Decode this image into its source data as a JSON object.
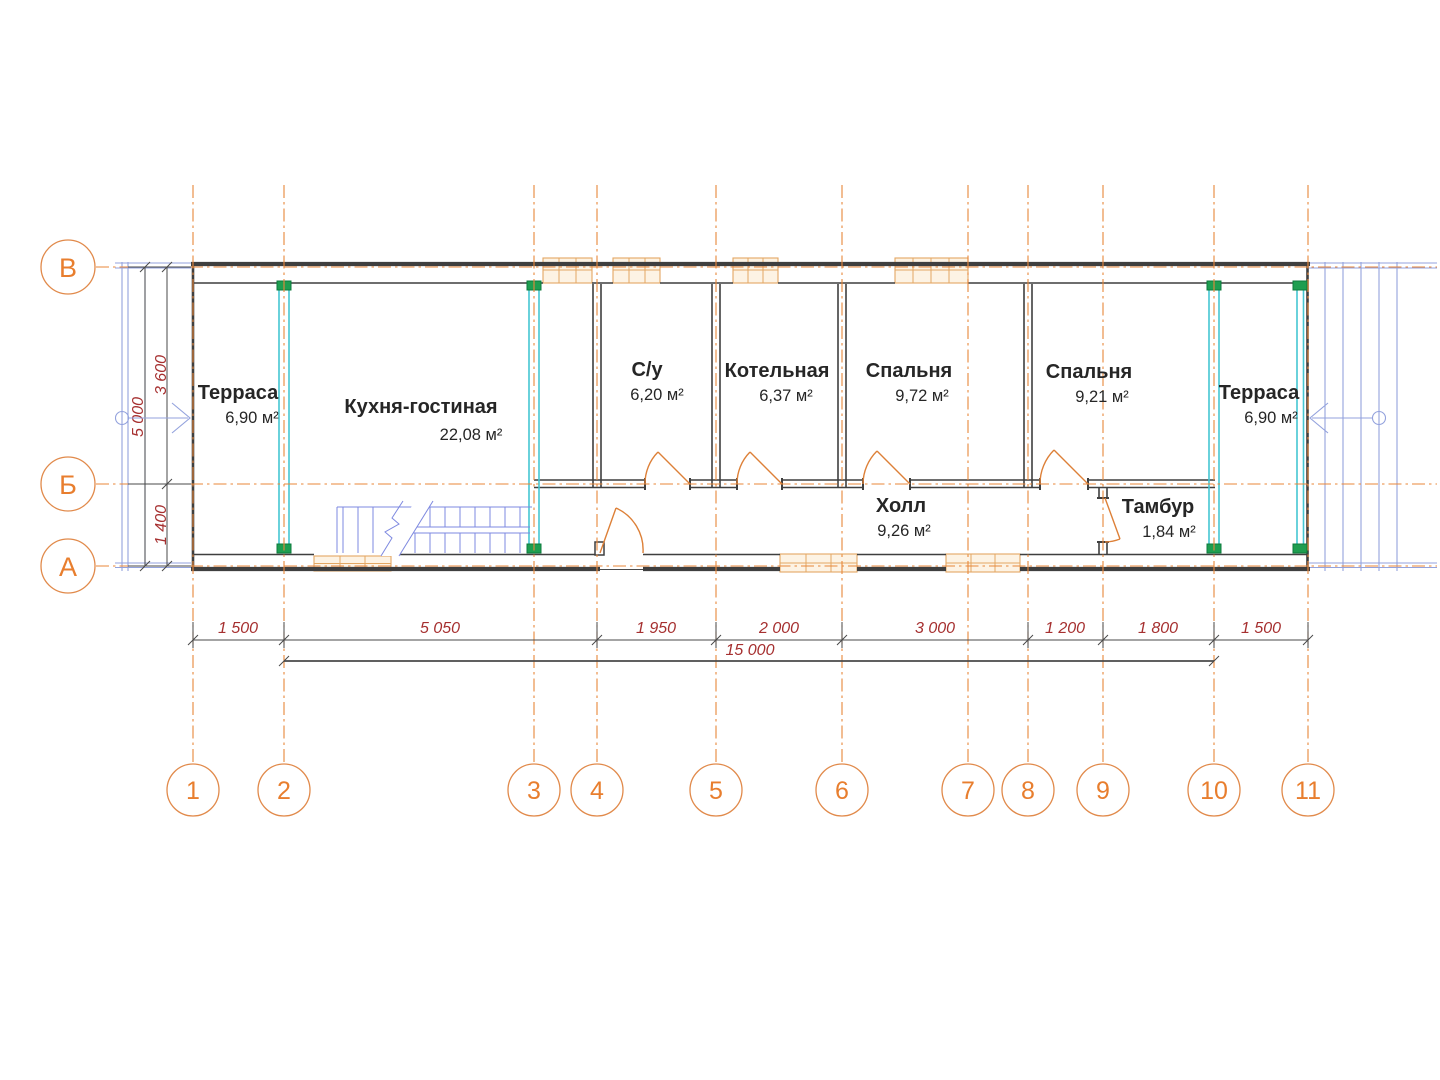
{
  "axes": {
    "rows": [
      "В",
      "Б",
      "А"
    ],
    "cols": [
      "1",
      "2",
      "3",
      "4",
      "5",
      "6",
      "7",
      "8",
      "9",
      "10",
      "11"
    ]
  },
  "rooms": [
    {
      "name": "Терраса",
      "area": "6,90 м²"
    },
    {
      "name": "Кухня-гостиная",
      "area": "22,08 м²"
    },
    {
      "name": "С/у",
      "area": "6,20 м²"
    },
    {
      "name": "Котельная",
      "area": "6,37 м²"
    },
    {
      "name": "Спальня",
      "area": "9,72 м²"
    },
    {
      "name": "Спальня",
      "area": "9,21 м²"
    },
    {
      "name": "Терраса",
      "area": "6,90 м²"
    },
    {
      "name": "Холл",
      "area": "9,26 м²"
    },
    {
      "name": "Тамбур",
      "area": "1,84 м²"
    }
  ],
  "dims": {
    "bottom": [
      "1 500",
      "5 050",
      "1 950",
      "2 000",
      "3 000",
      "1 200",
      "1 800",
      "1 500"
    ],
    "total": "15 000",
    "left": [
      "5 000",
      "3 600",
      "1 400"
    ]
  },
  "colors": {
    "axis_orange": "#e8873a",
    "bubble_orange": "#e87e2e",
    "dim_red": "#a63030",
    "wall_dark": "#3f3f3f",
    "timber_cyan": "#45c6d2",
    "post_green": "#1e9e50",
    "stair_blue": "#7e89e0",
    "door_orange": "#dd8038",
    "window_orange": "#e3a763"
  }
}
